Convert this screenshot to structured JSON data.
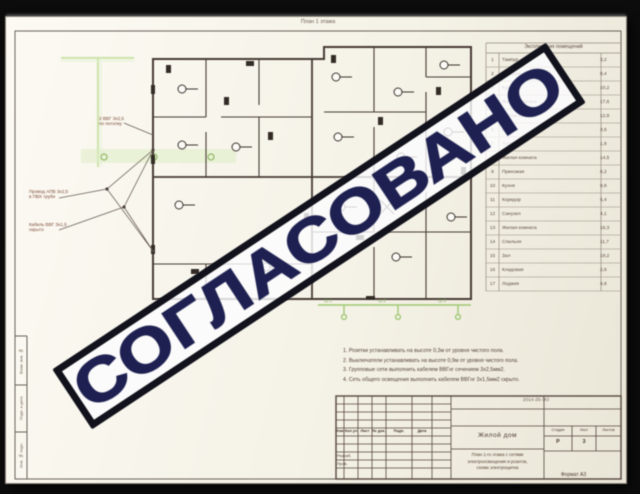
{
  "stamp": {
    "text": "СОГЛАСОВАНО",
    "ink": "#1d2050",
    "border": "#12121c"
  },
  "sheet": {
    "plan_caption": "План 1 этажа",
    "legend": {
      "title": "Экспликация помещений",
      "rows": [
        {
          "num": "1",
          "name": "Тамбур",
          "area": "3,2"
        },
        {
          "num": "2",
          "name": "Коридор",
          "area": "8,4"
        },
        {
          "num": "3",
          "name": "Кухня",
          "area": "10,2"
        },
        {
          "num": "4",
          "name": "Жилая комната",
          "area": "17,6"
        },
        {
          "num": "5",
          "name": "Жилая комната",
          "area": "12,8"
        },
        {
          "num": "6",
          "name": "Ванная",
          "area": "3,6"
        },
        {
          "num": "7",
          "name": "Туалет",
          "area": "1,8"
        },
        {
          "num": "8",
          "name": "Жилая комната",
          "area": "14,5"
        },
        {
          "num": "9",
          "name": "Прихожая",
          "area": "6,2"
        },
        {
          "num": "10",
          "name": "Кухня",
          "area": "9,8"
        },
        {
          "num": "11",
          "name": "Коридор",
          "area": "5,4"
        },
        {
          "num": "12",
          "name": "Санузел",
          "area": "4,1"
        },
        {
          "num": "13",
          "name": "Жилая комната",
          "area": "16,3"
        },
        {
          "num": "14",
          "name": "Спальня",
          "area": "11,7"
        },
        {
          "num": "15",
          "name": "Зал",
          "area": "19,2"
        },
        {
          "num": "16",
          "name": "Кладовая",
          "area": "2,6"
        },
        {
          "num": "17",
          "name": "Лоджия",
          "area": "4,8"
        }
      ]
    },
    "cable_labels": [
      {
        "line1": "2 ВВГ 3х2,5",
        "line2": "по потолку"
      },
      {
        "line1": "Провод АПВ 3х2,5",
        "line2": "в ПВХ трубе"
      },
      {
        "line1": "Кабель ВВГ 3х1,5",
        "line2": "скрыто"
      }
    ],
    "riser_labels": [
      "гр.1",
      "гр.2",
      "гр.3"
    ],
    "notes": [
      "1. Розетки устанавливать на высоте 0,3м от уровня чистого пола.",
      "2. Выключатели устанавливать на высоте 0,9м от уровня чистого пола.",
      "3. Групповые сети выполнить кабелем ВВГнг сечением 3х2,5мм2.",
      "4. Сеть общего освещения выполнить кабелем ВВГнг 3х1,5мм2 скрыто."
    ],
    "margin_labels": [
      "Взам. инв. №",
      "Подп. и дата",
      "Инв. № подл."
    ],
    "title_block": {
      "doc_code": "2014-25-ЭО",
      "revision_headers": [
        "Изм.",
        "Кол.уч",
        "Лист",
        "№ док.",
        "Подп.",
        "Дата"
      ],
      "roles": [
        "Разраб.",
        "Пров."
      ],
      "object": "Жилой дом",
      "description": [
        "План 1-го этажа с сетями",
        "электроосвещения и розеток,",
        "схема электрощитка"
      ],
      "stage_label": "Стадия",
      "sheet_label": "Лист",
      "sheets_label": "Листов",
      "stage_value": "Р",
      "sheet_value": "3",
      "format_note": "Формат А3"
    }
  }
}
